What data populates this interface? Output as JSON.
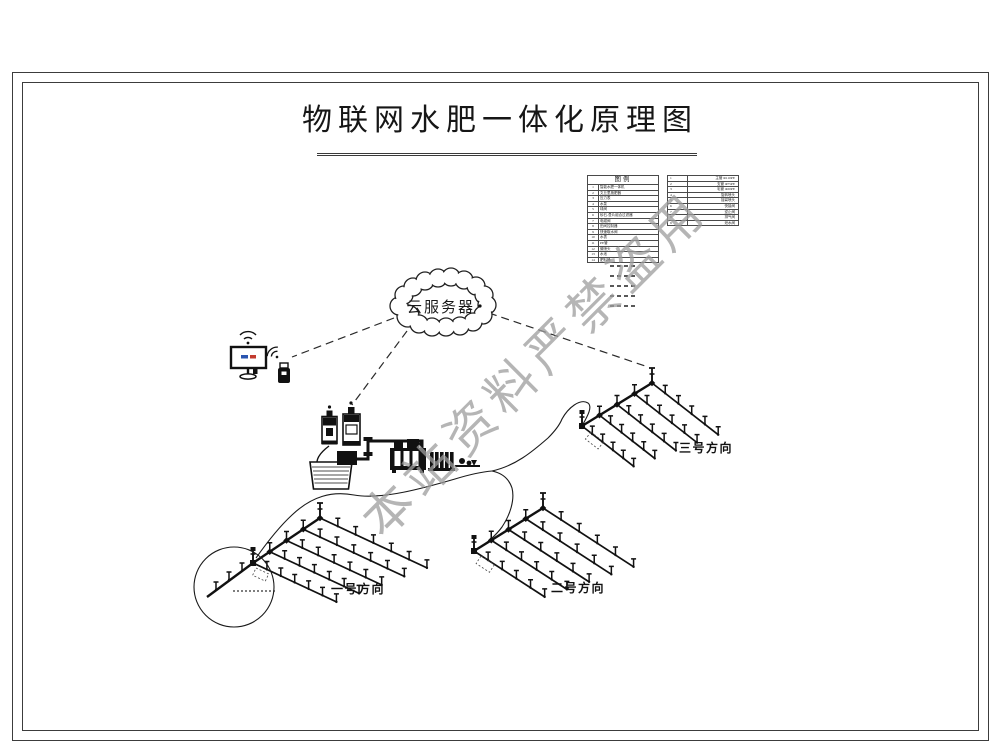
{
  "page": {
    "title": "物联网水肥一体化原理图"
  },
  "watermark": {
    "text": "本站资料严禁盗用",
    "color": "#9d9d9d"
  },
  "cloud": {
    "label": "云服务器"
  },
  "legend": {
    "title": "图例",
    "left_rows": [
      {
        "no": "1",
        "name": "智能水肥一体机"
      },
      {
        "no": "2",
        "name": "文丘里施肥器"
      },
      {
        "no": "3",
        "name": "压力表"
      },
      {
        "no": "4",
        "name": "水泵"
      },
      {
        "no": "5",
        "name": "球阀"
      },
      {
        "no": "6",
        "name": "砂石-叠片组合过滤器"
      },
      {
        "no": "7",
        "name": "电磁阀"
      },
      {
        "no": "8",
        "name": "田间控制器"
      },
      {
        "no": "9",
        "name": "快速取水阀"
      },
      {
        "no": "10",
        "name": "水表"
      },
      {
        "no": "11",
        "name": "PE管"
      },
      {
        "no": "12",
        "name": "微喷头"
      },
      {
        "no": "13",
        "name": "水池"
      },
      {
        "no": "14",
        "name": "肥料桶"
      }
    ],
    "right_rows": [
      {
        "no": "1",
        "name": "主管 Φ110PE"
      },
      {
        "no": "2",
        "name": "支管 Φ75PE"
      },
      {
        "no": "3",
        "name": "毛管 Φ20PE"
      },
      {
        "no": "4",
        "name": "旋转喷头"
      },
      {
        "no": "5",
        "name": "摇臂喷头"
      },
      {
        "no": "6",
        "name": "快接阀"
      },
      {
        "no": "7",
        "name": "逆止阀"
      },
      {
        "no": "8",
        "name": "排气阀"
      },
      {
        "no": "9",
        "name": "泄水阀"
      }
    ]
  },
  "fields": [
    {
      "label": "一号方向"
    },
    {
      "label": "二号方向"
    },
    {
      "label": "三号方向"
    }
  ],
  "colors": {
    "line": "#1a1a1a",
    "screen_blue": "#2a55b0",
    "screen_red": "#c23a2e"
  }
}
